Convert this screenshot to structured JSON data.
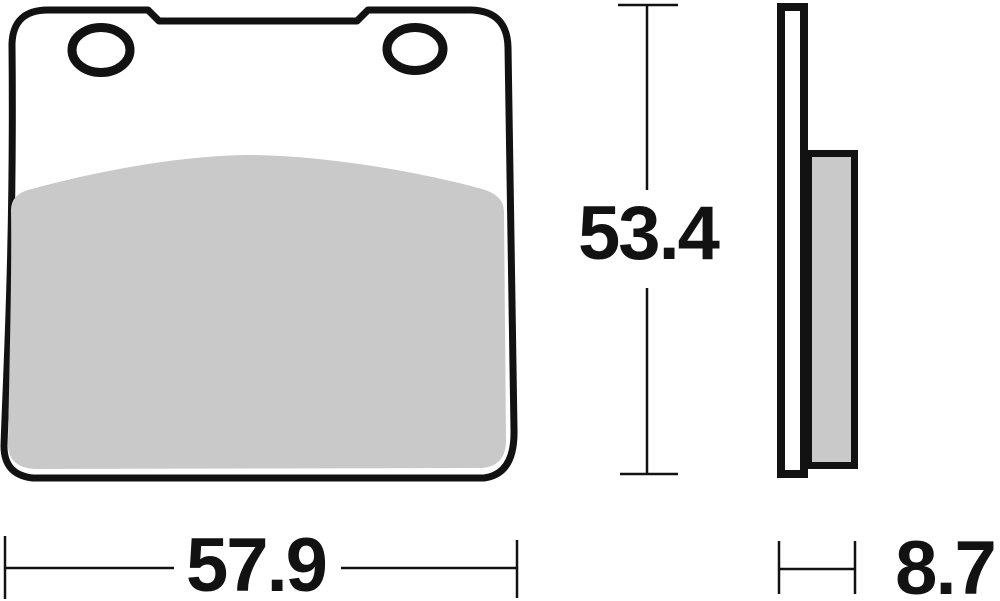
{
  "diagram": {
    "title": "brake-pad-technical-drawing",
    "dimensions": {
      "width_mm": "57.9",
      "height_mm": "53.4",
      "thickness_mm": "8.7"
    },
    "colors": {
      "outline": "#121212",
      "friction_material": "#c9c9c9",
      "background": "#ffffff"
    },
    "views": {
      "front": "front-view-of-brake-pad-with-two-mounting-holes",
      "side": "side-profile-with-backing-plate-and-friction-layer"
    }
  }
}
